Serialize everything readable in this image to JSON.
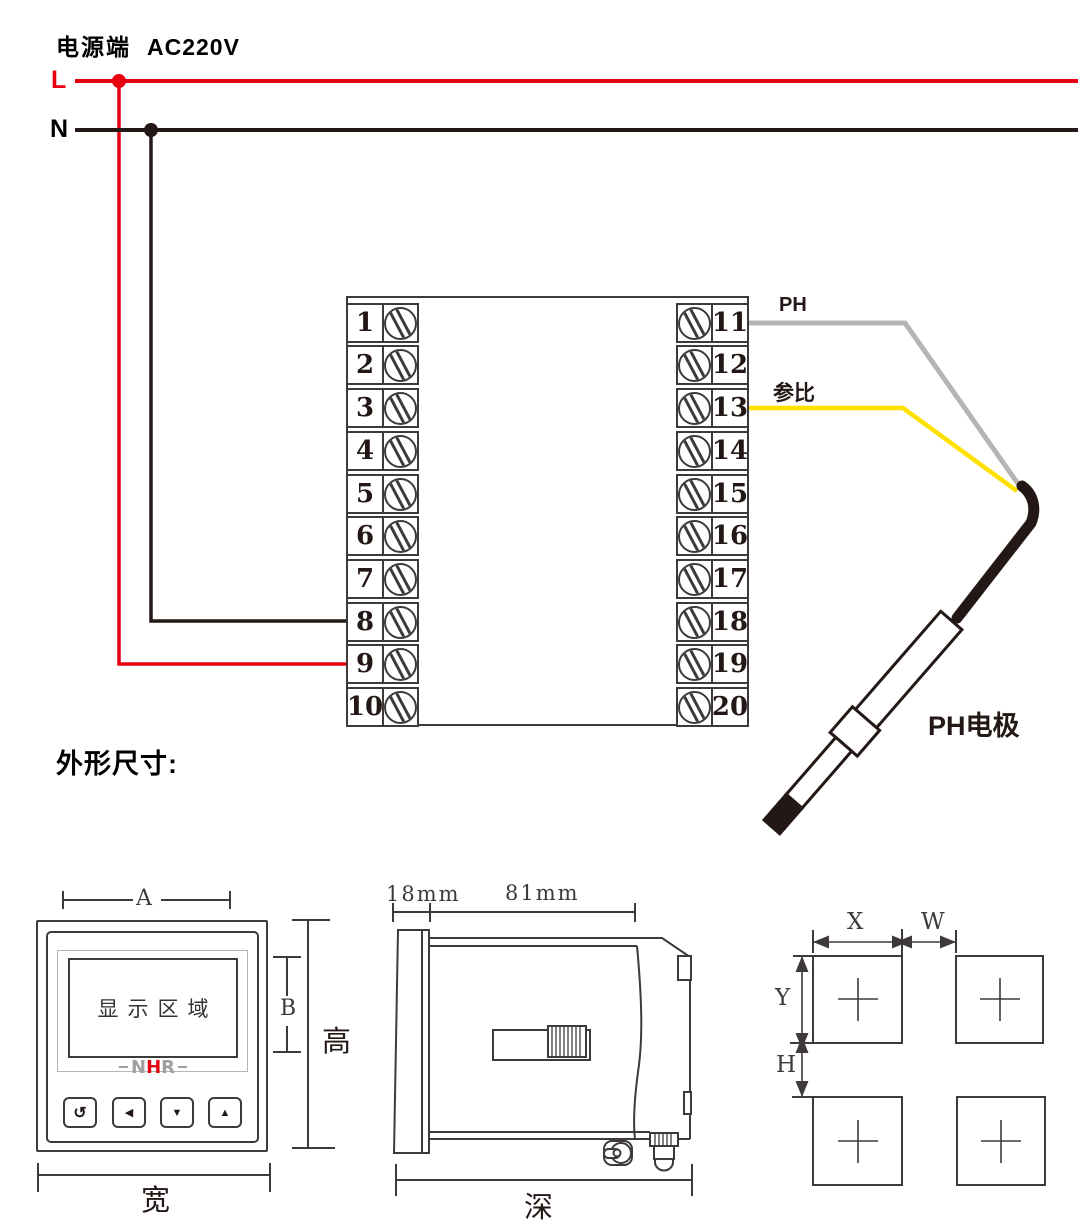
{
  "colors": {
    "ink": "#3e3a39",
    "black": "#231815",
    "red": "#e60012",
    "yellow": "#ffe100",
    "gray_wire": "#b5b5b6",
    "logo_gray": "#9fa0a0"
  },
  "power": {
    "title": "电源端",
    "voltage": "AC220V",
    "live_label": "L",
    "neutral_label": "N"
  },
  "terminal_block": {
    "left_numbers": [
      "1",
      "2",
      "3",
      "4",
      "5",
      "6",
      "7",
      "8",
      "9",
      "10"
    ],
    "right_numbers": [
      "11",
      "12",
      "13",
      "14",
      "15",
      "16",
      "17",
      "18",
      "19",
      "20"
    ]
  },
  "wiring": {
    "ph_label": "PH",
    "reference_label": "参比",
    "electrode_label": "PH电极"
  },
  "section": {
    "outline_title": "外形尺寸:"
  },
  "front_view": {
    "dim_a": "A",
    "dim_b": "B",
    "height_label": "高",
    "width_label": "宽",
    "display_label": "显示区域",
    "logo": {
      "n": "N",
      "h": "H",
      "r": "R"
    },
    "buttons": [
      "↺",
      "◀",
      "▼",
      "▲"
    ]
  },
  "side_view": {
    "dim_18": "18mm",
    "dim_81": "81mm",
    "depth_label": "深"
  },
  "cutout": {
    "dim_x": "X",
    "dim_w": "W",
    "dim_y": "Y",
    "dim_h": "H"
  }
}
